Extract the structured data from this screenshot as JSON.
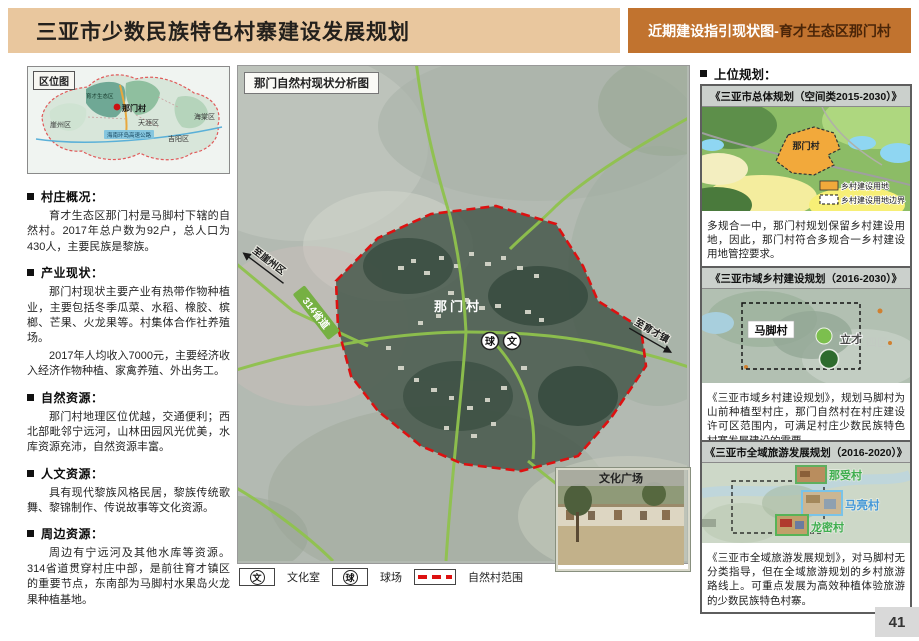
{
  "header": {
    "title": "三亚市少数民族特色村寨建设发展规划",
    "subtitle_prefix": "近期建设指引现状图-",
    "subtitle_suffix": "育才生态区那门村"
  },
  "left": {
    "location": {
      "title": "区位图",
      "zone": "育才生态区",
      "village": "那门村",
      "districts": [
        "崖州区",
        "天涯区",
        "吉阳区",
        "海棠区"
      ],
      "road": "海南环岛高速公路"
    },
    "sections": [
      {
        "heading": "村庄概况：",
        "p1": "育才生态区那门村是马脚村下辖的自然村。2017年总户数为92户，总人口为430人，主要民族是黎族。"
      },
      {
        "heading": "产业现状：",
        "p1": "那门村现状主要产业有热带作物种植业，主要包括冬季瓜菜、水稻、橡胶、槟榔、芒果、火龙果等。村集体合作社养殖场。",
        "p2": "2017年人均收入7000元，主要经济收入经济作物种植、家禽养殖、外出务工。"
      },
      {
        "heading": "自然资源：",
        "p1": "那门村地理区位优越，交通便利；西北部毗邻宁远河，山林田园风光优美，水库资源充沛，自然资源丰富。"
      },
      {
        "heading": "人文资源：",
        "p1": "具有现代黎族风格民居，黎族传统歌舞、黎锦制作、传说故事等文化资源。"
      },
      {
        "heading": "周边资源：",
        "p1": "周边有宁远河及其他水库等资源。314省道贯穿村庄中部，是前往育才镇区的重要节点，东南部为马脚村水果岛火龙果种植基地。"
      }
    ]
  },
  "map": {
    "title": "那门自然村现状分析图",
    "village": "那门村",
    "road": "314省道",
    "dir_nw": "至崖州区",
    "dir_se": "至育才镇",
    "icon_ball": "球",
    "icon_culture": "文",
    "inset": "文化广场",
    "legend": {
      "culture_icon": "文",
      "culture": "文化室",
      "ball_icon": "球",
      "ball": "球场",
      "boundary": "自然村范围"
    }
  },
  "right": {
    "heading": "上位规划：",
    "panel1": {
      "title": "《三亚市总体规划（空间类2015-2030）》",
      "map_label": "那门村",
      "legend1": "乡村建设用地",
      "legend2": "乡村建设用地边界",
      "text": "多规合一中，那门村规划保留乡村建设用地，因此，那门村符合多规合一乡村建设用地管控要求。"
    },
    "panel2": {
      "title": "《三亚市域乡村建设规划（2016-2030）》",
      "village": "马脚村",
      "area1": "立才",
      "area2": "四区",
      "text": "《三亚市域乡村建设规划》，规划马脚村为山前种植型村庄，那门自然村在村庄建设许可区范围内，可满足村庄少数民族特色村寨发展建设的需要。"
    },
    "panel3": {
      "title": "《三亚市全域旅游发展规划（2016-2020）》",
      "v1": "那受村",
      "v2": "马亮村",
      "v3": "龙密村",
      "text": "《三亚市全域旅游发展规划》，对马脚村无分类指导，但在全域旅游规划的乡村旅游路线上。可重点发展为高效种植体验旅游的少数民族特色村寨。"
    }
  },
  "page_number": "41",
  "colors": {
    "header_left_bg": "#e9c79e",
    "header_right_bg": "#c1732f",
    "boundary_red": "#dd1111",
    "road_green": "#8fc24d",
    "build_land_orange": "#f2a93b"
  }
}
